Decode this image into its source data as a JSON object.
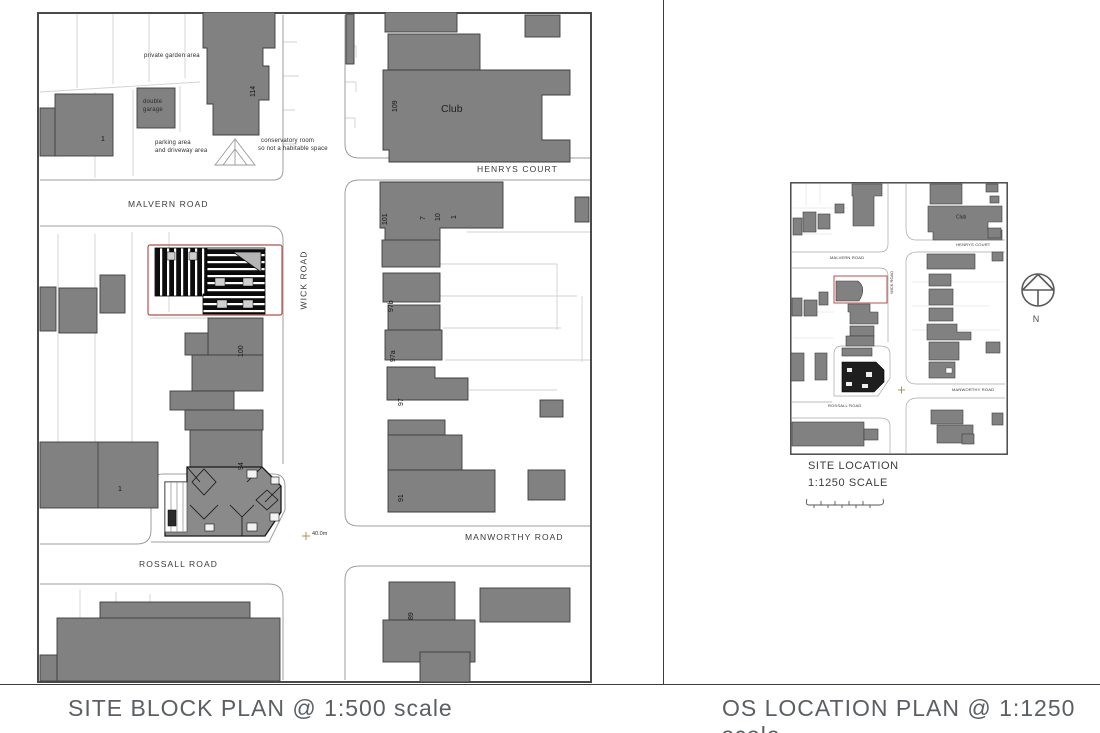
{
  "captions": {
    "left": "SITE BLOCK PLAN @ 1:500 scale",
    "right": "OS LOCATION PLAN @ 1:1250 scale"
  },
  "block_plan": {
    "roads": {
      "malvern": "MALVERN ROAD",
      "wick": "WICK ROAD",
      "henrys": "HENRYS COURT",
      "manworthy": "MANWORTHY ROAD",
      "rossall": "ROSSALL ROAD"
    },
    "labels": {
      "private_garden": "private garden area",
      "double_garage_1": "double",
      "double_garage_2": "garage",
      "parking_1": "parking area",
      "parking_2": "and driveway area",
      "conservatory_1": "conservatory room",
      "conservatory_2": "so not a habitable space",
      "club": "Club",
      "spot_plus": "+",
      "spot_level": "40.0m"
    },
    "numbers": {
      "n1_top": "1",
      "n114": "114",
      "n109": "109",
      "n101": "101",
      "n7": "7",
      "n10": "10",
      "n1_row": "1",
      "n100": "100",
      "n97b": "97b",
      "n97a": "97a",
      "n97": "97",
      "n94": "94",
      "n91": "91",
      "n1_bottom": "1",
      "n89": "89"
    }
  },
  "location_plan": {
    "title": "SITE LOCATION",
    "scale_text": "1:1250 SCALE",
    "roads": {
      "malvern": "MALVERN ROAD",
      "wick": "WICK ROAD",
      "henrys": "HENRYS COURT",
      "manworthy": "MANWORTHY ROAD",
      "rossall": "ROSSALL ROAD"
    },
    "club": "Club"
  },
  "compass": {
    "north": "N"
  },
  "colors": {
    "building_fill": "#818181",
    "site_boundary_red": "#b4524c",
    "roof_hatch_black": "#0d0d0d",
    "kerb_line": "#9e9e9e",
    "parcel_line": "#d2d2d2",
    "caption_text": "#5b5f63",
    "spot_marker": "#b39347"
  }
}
